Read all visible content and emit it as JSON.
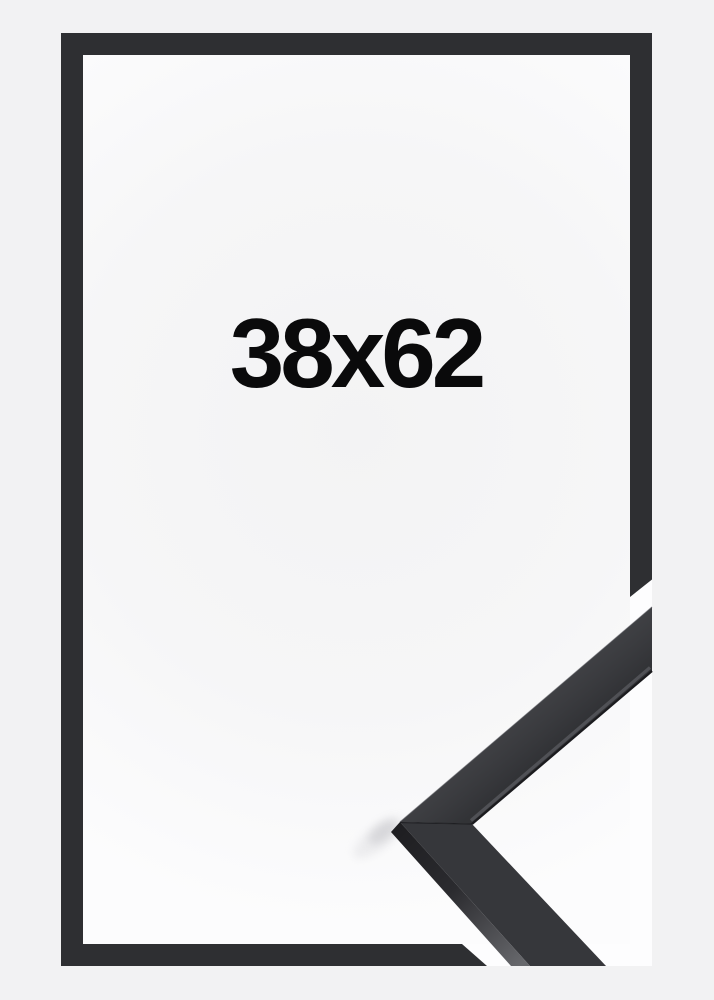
{
  "image": {
    "size_label": "38x62",
    "colors": {
      "background": "#f2f2f3",
      "inner_background": "#f6f6f7",
      "photo_white": "#fdfdfe",
      "frame": "#2e2f32",
      "moulding_face": "#36373b",
      "moulding_side_light": "#56575c",
      "moulding_edge_dark": "#1b1b1e",
      "shadow": "#c9c9cd",
      "label_text": "#0a0a0b"
    }
  }
}
